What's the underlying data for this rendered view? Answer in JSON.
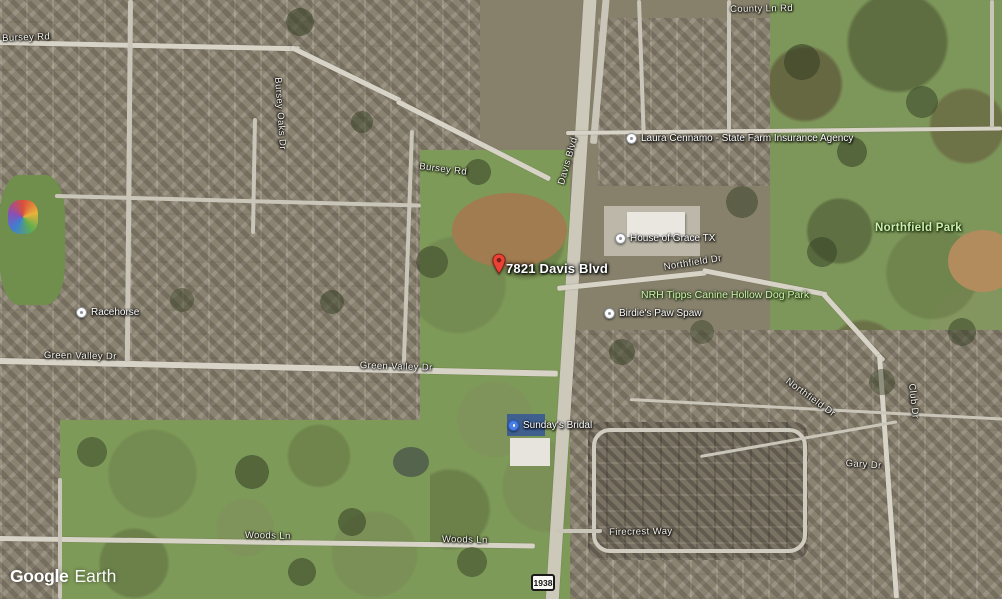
{
  "watermark": {
    "brand": "Google",
    "product": "Earth"
  },
  "route_shield": {
    "number": "1938"
  },
  "marker": {
    "label": "7821 Davis Blvd"
  },
  "road_labels": [
    {
      "text": "Bursey Rd"
    },
    {
      "text": "Bursey Rd"
    },
    {
      "text": "County Ln Rd"
    },
    {
      "text": "Davis Blvd"
    },
    {
      "text": "Green Valley Dr"
    },
    {
      "text": "Green Valley Dr"
    },
    {
      "text": "Woods Ln"
    },
    {
      "text": "Woods Ln"
    },
    {
      "text": "Firecrest Way"
    },
    {
      "text": "Northfield Dr"
    },
    {
      "text": "Northfield Dr"
    },
    {
      "text": "Bursey Oaks Dr"
    },
    {
      "text": "Gary Dr"
    },
    {
      "text": "Club Dr"
    }
  ],
  "poi_labels": [
    {
      "text": "Laura Cennamo - State Farm Insurance Agency",
      "icon": "place-circle"
    },
    {
      "text": "House of Grace TX",
      "icon": "place-circle"
    },
    {
      "text": "Birdie's Paw Spaw",
      "icon": "place-circle"
    },
    {
      "text": "Racehorse",
      "icon": "place-circle"
    },
    {
      "text": "Sunday's Bridal",
      "icon": "shopping-bag-blue"
    }
  ],
  "park_labels": [
    {
      "text": "Northfield Park"
    },
    {
      "text": "NRH Tipps Canine Hollow Dog Park"
    }
  ],
  "colors": {
    "pin_red": "#ea4335",
    "poi_blue": "#4a7fe8",
    "park_label_green": "#d2edb3",
    "road_label_white": "#f5f3ec"
  }
}
